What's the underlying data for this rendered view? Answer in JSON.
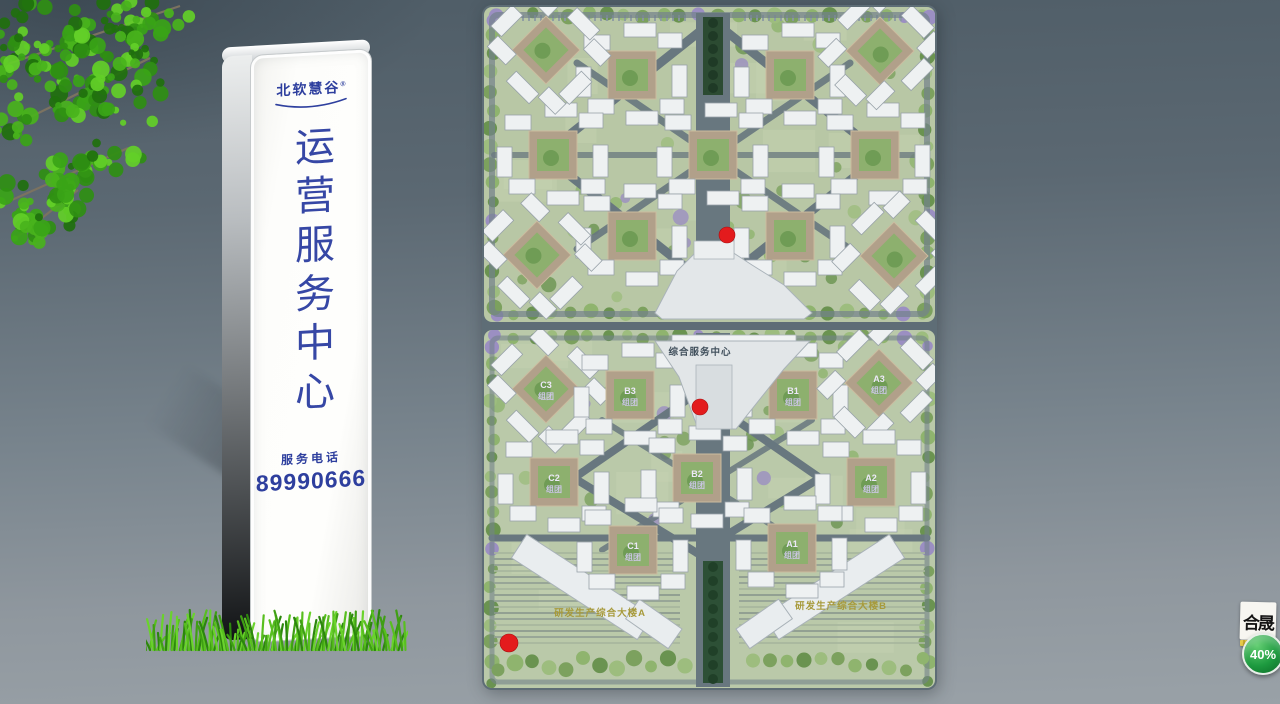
{
  "signage": {
    "brand": "北软慧谷",
    "brand_mark": "®",
    "title": "运营服务中心",
    "phone_label": "服务电话",
    "phone_number": "89990666",
    "text_color": "#3647a5"
  },
  "map": {
    "service_center_label": "综合服务中心",
    "building_a_label": "研发生产综合大楼A",
    "building_b_label": "研发生产综合大楼B",
    "cluster_suffix": "组团",
    "clusters": [
      {
        "s": "t",
        "x": 150,
        "y": 70
      },
      {
        "s": "t",
        "x": 308,
        "y": 70
      },
      {
        "s": "t",
        "x": 71,
        "y": 150
      },
      {
        "s": "t",
        "x": 231,
        "y": 150
      },
      {
        "s": "t",
        "x": 393,
        "y": 150
      },
      {
        "s": "t",
        "x": 150,
        "y": 231
      },
      {
        "s": "t",
        "x": 308,
        "y": 231
      },
      {
        "s": "t",
        "x": 64,
        "y": 45,
        "rot": 45
      },
      {
        "s": "t",
        "x": 398,
        "y": 46,
        "rot": -45
      },
      {
        "s": "t",
        "x": 55,
        "y": 250,
        "rot": 45
      },
      {
        "s": "t",
        "x": 412,
        "y": 251,
        "rot": -45
      },
      {
        "s": "b",
        "name": "C3",
        "x": 64,
        "y": 384,
        "rot": 45
      },
      {
        "s": "b",
        "name": "B3",
        "x": 148,
        "y": 390
      },
      {
        "s": "b",
        "name": "B1",
        "x": 311,
        "y": 390
      },
      {
        "s": "b",
        "name": "A3",
        "x": 397,
        "y": 378,
        "rot": -45
      },
      {
        "s": "b",
        "name": "C2",
        "x": 72,
        "y": 477
      },
      {
        "s": "b",
        "name": "B2",
        "x": 215,
        "y": 473
      },
      {
        "s": "b",
        "name": "A2",
        "x": 389,
        "y": 477
      },
      {
        "s": "b",
        "name": "C1",
        "x": 151,
        "y": 545
      },
      {
        "s": "b",
        "name": "A1",
        "x": 310,
        "y": 543
      }
    ],
    "markers": [
      {
        "x": 245,
        "y": 230,
        "r": 8
      },
      {
        "x": 218,
        "y": 402,
        "r": 8
      },
      {
        "x": 27,
        "y": 638,
        "r": 9
      }
    ],
    "marker_color": "#e31b1d",
    "building_label_color": "#a79a3b",
    "cluster_label_color": "#cfc8ea"
  },
  "watermark": {
    "logo": "合晟",
    "badge": "40%"
  }
}
